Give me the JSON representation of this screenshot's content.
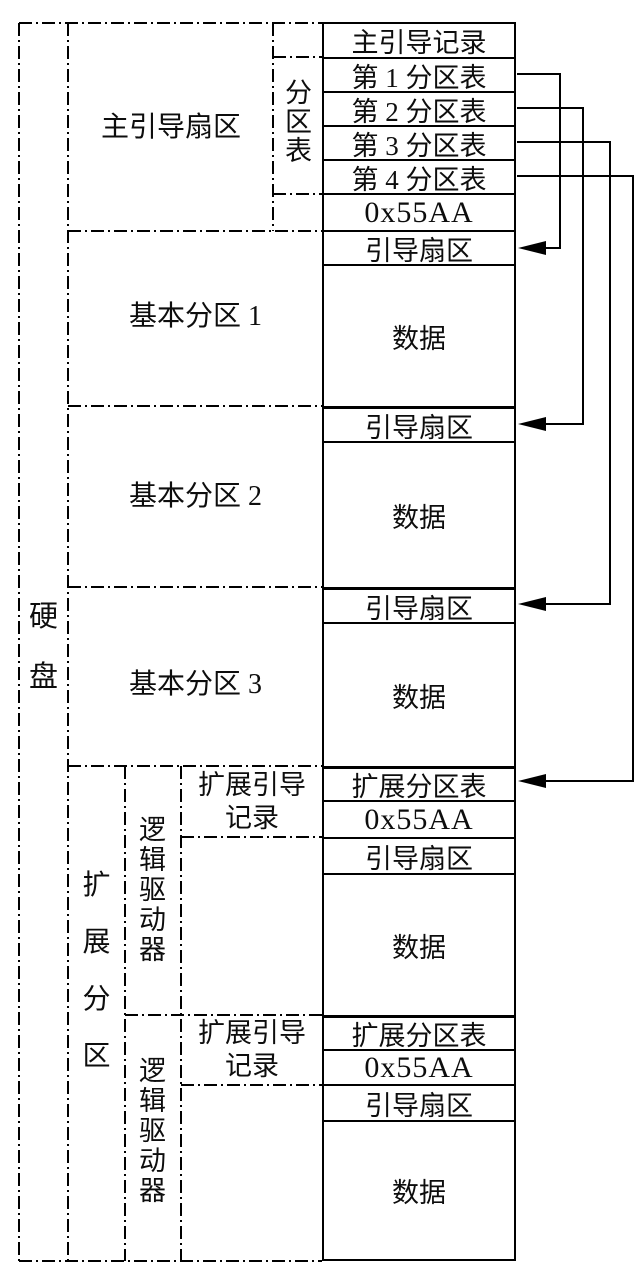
{
  "diagram": {
    "background": "#ffffff",
    "line_color": "#000000",
    "disk": {
      "label": "硬盘"
    },
    "sections": {
      "mbr_sector": {
        "label": "主引导扇区"
      },
      "partition_table": {
        "label": "分区表"
      },
      "primary_1": {
        "label": "基本分区 1"
      },
      "primary_2": {
        "label": "基本分区 2"
      },
      "primary_3": {
        "label": "基本分区 3"
      },
      "extended": {
        "label": "扩展分区"
      },
      "logical_drive_1": {
        "label": "逻辑驱动器"
      },
      "logical_drive_2": {
        "label": "逻辑驱动器"
      },
      "ebr_1": {
        "label": "扩展引导\n记录"
      },
      "ebr_2": {
        "label": "扩展引导\n记录"
      }
    },
    "table": {
      "rows": [
        {
          "label": "主引导记录"
        },
        {
          "label": "第 1 分区表"
        },
        {
          "label": "第 2 分区表"
        },
        {
          "label": "第 3 分区表"
        },
        {
          "label": "第 4 分区表"
        },
        {
          "label": "0x55AA"
        },
        {
          "label": "引导扇区"
        },
        {
          "label": "数据"
        },
        {
          "label": "引导扇区"
        },
        {
          "label": "数据"
        },
        {
          "label": "引导扇区"
        },
        {
          "label": "数据"
        },
        {
          "label": "扩展分区表"
        },
        {
          "label": "0x55AA"
        },
        {
          "label": "引导扇区"
        },
        {
          "label": "数据"
        },
        {
          "label": "扩展分区表"
        },
        {
          "label": "0x55AA"
        },
        {
          "label": "引导扇区"
        },
        {
          "label": "数据"
        }
      ]
    },
    "arrows": [
      {
        "from": "第 1 分区表",
        "to": "基本分区 1 引导扇区"
      },
      {
        "from": "第 2 分区表",
        "to": "基本分区 2 引导扇区"
      },
      {
        "from": "第 3 分区表",
        "to": "基本分区 3 引导扇区"
      },
      {
        "from": "第 4 分区表",
        "to": "扩展分区表"
      }
    ]
  }
}
